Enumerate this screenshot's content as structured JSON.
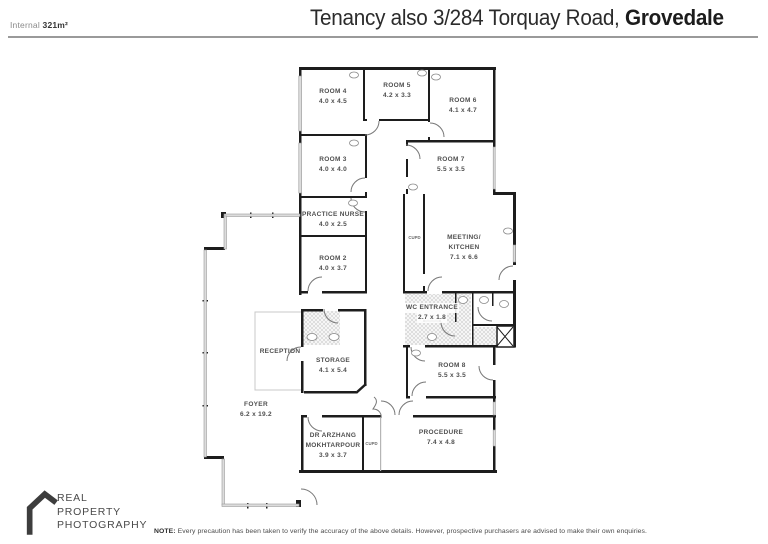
{
  "header": {
    "internal_label": "Internal",
    "internal_value": "321m²",
    "title_regular": "Tenancy also 3/284 Torquay Road, ",
    "title_bold": "Grovedale"
  },
  "colors": {
    "wall": "#1d1d1d",
    "window_fill": "#dcdcdc",
    "label_text": "#4f4f4f"
  },
  "floorplan": {
    "rooms": {
      "room4": {
        "name": "ROOM 4",
        "dims": "4.0 x 4.5"
      },
      "room5": {
        "name": "ROOM 5",
        "dims": "4.2 x 3.3"
      },
      "room6": {
        "name": "ROOM 6",
        "dims": "4.1 x 4.7"
      },
      "room3": {
        "name": "ROOM 3",
        "dims": "4.0 x 4.0"
      },
      "room7": {
        "name": "ROOM 7",
        "dims": "5.5 x 3.5"
      },
      "practice_nurse": {
        "name": "PRACTICE NURSE",
        "dims": "4.0 x 2.5"
      },
      "room2": {
        "name": "ROOM 2",
        "dims": "4.0 x 3.7"
      },
      "cupd1": {
        "name": "CUPD"
      },
      "meeting": {
        "name": "MEETING/",
        "name2": "KITCHEN",
        "dims": "7.1 x 6.6"
      },
      "wc": {
        "name": "WC ENTRANCE",
        "dims": "2.7 x 1.8"
      },
      "reception": {
        "name": "RECEPTION"
      },
      "storage": {
        "name": "STORAGE",
        "dims": "4.1 x 5.4"
      },
      "room8": {
        "name": "ROOM 8",
        "dims": "5.5 x 3.5"
      },
      "foyer": {
        "name": "FOYER",
        "dims": "6.2 x 19.2"
      },
      "dr": {
        "name": "DR ARZHANG",
        "name2": "MOKHTARPOUR",
        "dims": "3.9 x 3.7"
      },
      "cupd2": {
        "name": "CUPD"
      },
      "procedure": {
        "name": "PROCEDURE",
        "dims": "7.4 x 4.8"
      }
    }
  },
  "footer": {
    "logo_line1": "REAL",
    "logo_line2": "PROPERTY",
    "logo_line3": "PHOTOGRAPHY",
    "note_bold": "NOTE:",
    "note_text": " Every precaution has been taken to verify the accuracy of the above details. However, prospective purchasers are advised to make their own enquiries."
  }
}
